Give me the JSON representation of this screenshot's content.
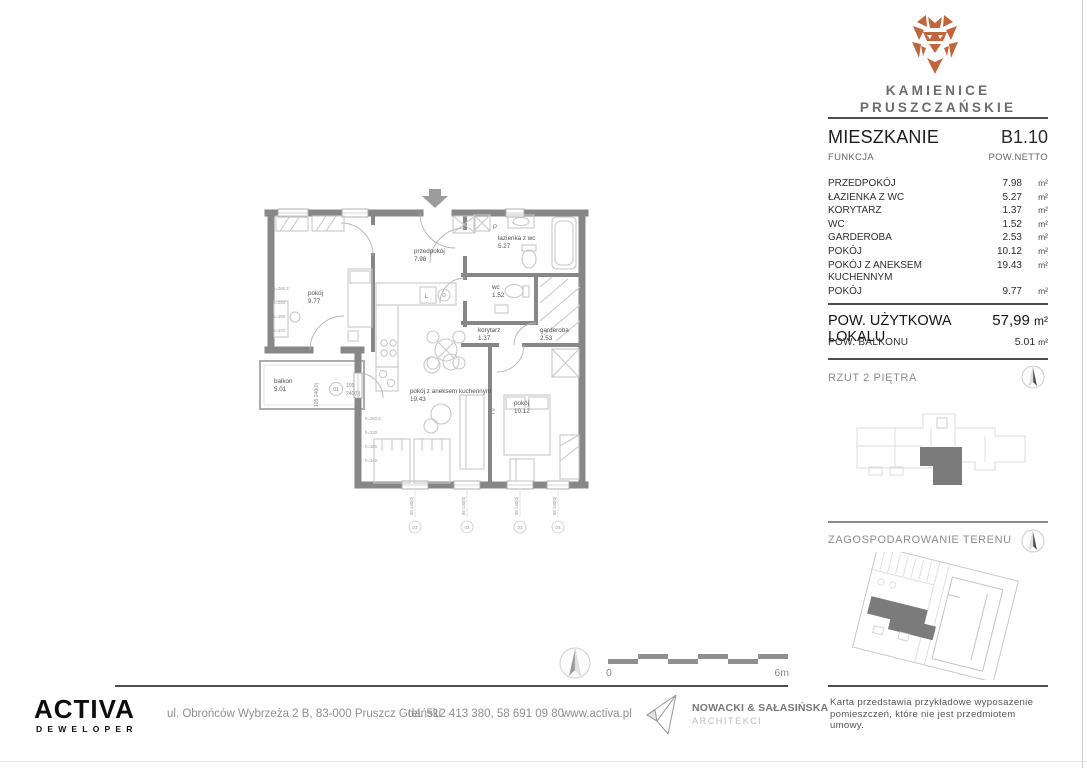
{
  "brand": {
    "line1": "KAMIENICE",
    "line2": "PRUSZCZAŃSKIE",
    "logo_color": "#c0653d"
  },
  "header": {
    "apartment_label": "MIESZKANIE",
    "apartment_number": "B1.10",
    "function_label": "FUNKCJA",
    "net_area_label": "POW.NETTO"
  },
  "rooms": [
    {
      "name": "PRZEDPOKÓJ",
      "area": "7.98",
      "unit": "m²"
    },
    {
      "name": "ŁAZIENKA Z WC",
      "area": "5.27",
      "unit": "m²"
    },
    {
      "name": "KORYTARZ",
      "area": "1.37",
      "unit": "m²"
    },
    {
      "name": "WC",
      "area": "1.52",
      "unit": "m²"
    },
    {
      "name": "GARDEROBA",
      "area": "2.53",
      "unit": "m²"
    },
    {
      "name": "POKÓJ",
      "area": "10.12",
      "unit": "m²"
    },
    {
      "name": "POKÓJ Z ANEKSEM KUCHENNYM",
      "area": "19.43",
      "unit": "m²"
    },
    {
      "name": "POKÓJ",
      "area": "9.77",
      "unit": "m²"
    }
  ],
  "summary": {
    "usable_label": "POW. UŻYTKOWA LOKALU",
    "usable_value": "57,99",
    "usable_unit": "m²",
    "balcony_label": "POW. BALKONU",
    "balcony_value": "5.01",
    "balcony_unit": "m²"
  },
  "floor_section": {
    "title": "RZUT 2 PIĘTRA"
  },
  "site_section": {
    "title": "ZAGOSPODAROWANIE TERENU"
  },
  "plan": {
    "rooms": {
      "pokoj1": {
        "name": "pokój",
        "area": "9.77"
      },
      "przedpokoj": {
        "name": "przedpokój",
        "area": "7.98"
      },
      "lazienka": {
        "name": "łazienka z wc",
        "area": "5.27"
      },
      "wc": {
        "name": "wc",
        "area": "1.52"
      },
      "korytarz": {
        "name": "korytarz",
        "area": "1.37"
      },
      "garderoba": {
        "name": "garderoba",
        "area": "2.53"
      },
      "salon": {
        "name": "pokój z aneksem kuchennym",
        "area": "19.43"
      },
      "pokoj2": {
        "name": "pokój",
        "area": "10.12"
      },
      "balkon": {
        "name": "balkon",
        "area": "5.01"
      }
    },
    "tv_label": "TV",
    "washer_label": "P",
    "fridge_label": "L",
    "door_tag": {
      "rotated": "105 240(0)",
      "number": "01",
      "dim1": "105",
      "dim2": "240(0)"
    },
    "window_tag": {
      "text": "85 140(0)",
      "number": "03"
    },
    "height_marks": [
      "h=260,2",
      "h=220",
      "h=180",
      "h=140"
    ]
  },
  "scale_bar": {
    "start": "0",
    "end": "6m"
  },
  "footer": {
    "developer": {
      "name": "ACTIVA",
      "subtitle": "DEWELOPER"
    },
    "address": "ul. Obrońców  Wybrzeża 2 B, 83-000 Pruszcz Gdański",
    "phone": "tel. 512 413 380, 58 691 09 80",
    "website": "www.activa.pl",
    "architect_name": "NOWACKI & SAŁASIŃSKA",
    "architect_sub": "ARCHITEKCI",
    "note_line1": "Karta przedstawia przykładowe wyposażenie",
    "note_line2": "pomieszczeń, które nie jest przedmiotem umowy."
  }
}
